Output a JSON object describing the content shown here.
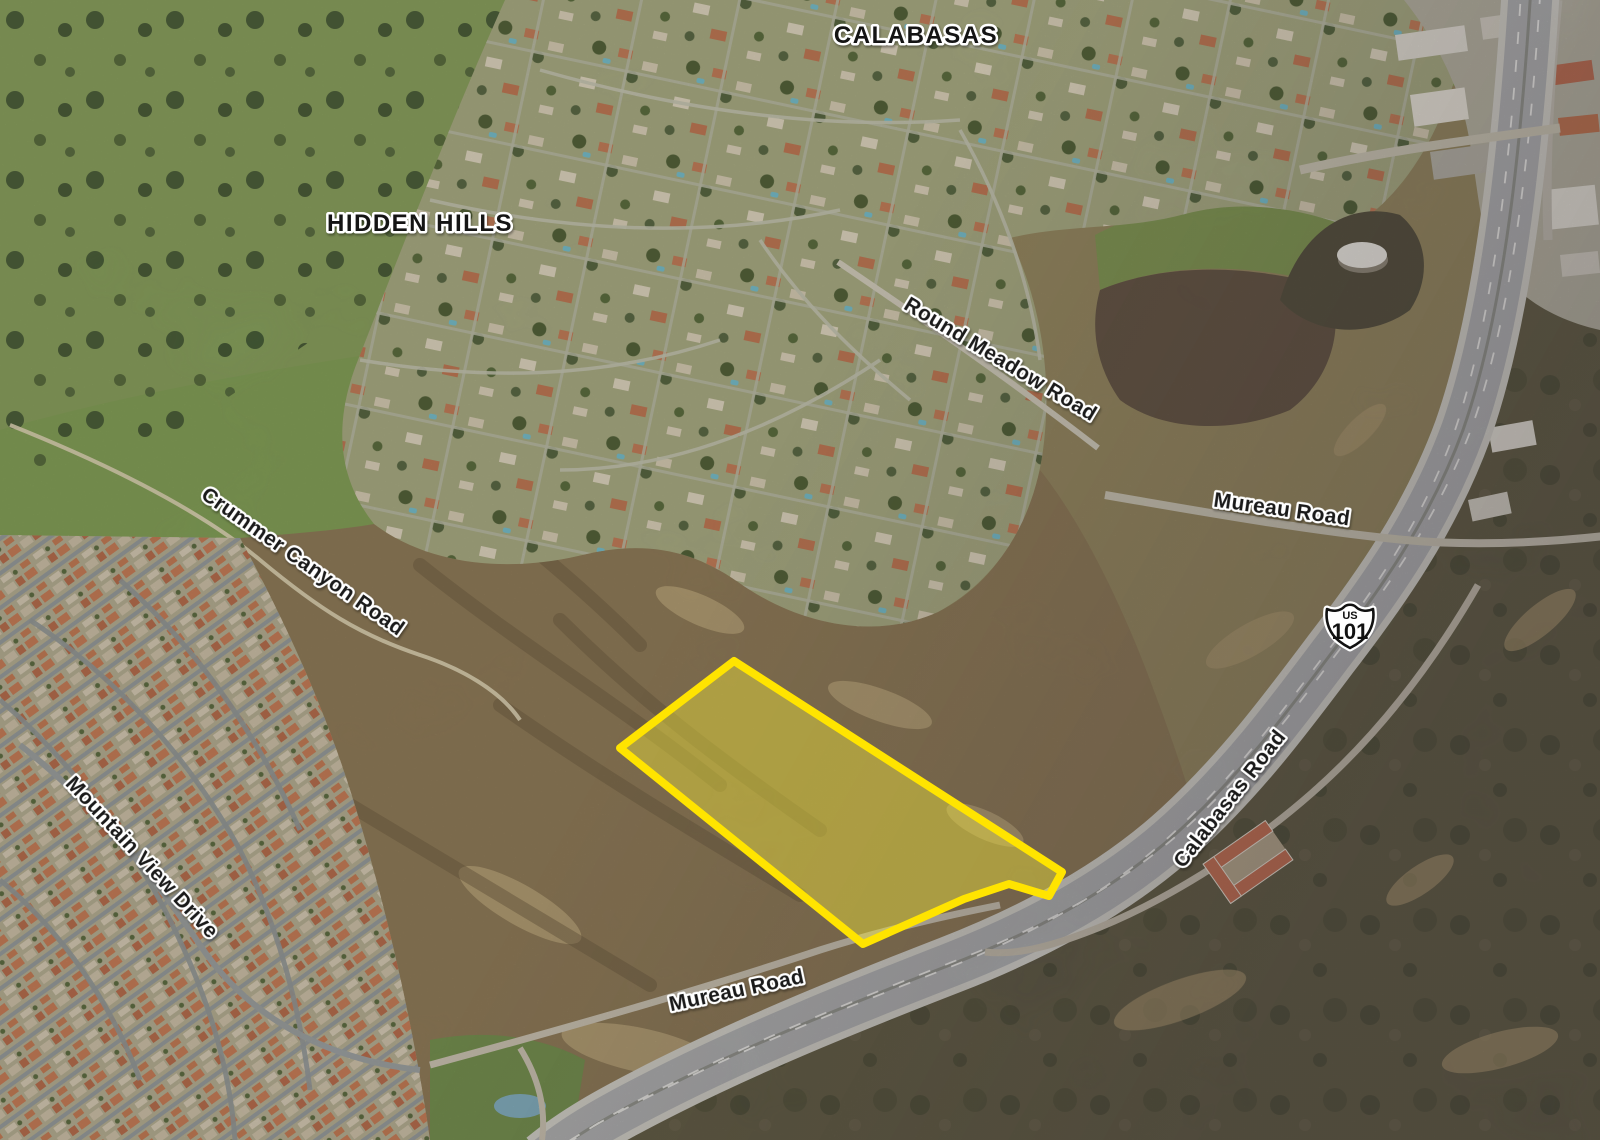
{
  "map": {
    "place_labels": {
      "calabasas": "CALABASAS",
      "hidden_hills": "HIDDEN HILLS"
    },
    "road_labels": {
      "round_meadow": "Round Meadow Road",
      "mureau_upper": "Mureau Road",
      "calabasas_road": "Calabasas Road",
      "crummer_canyon": "Crummer Canyon Road",
      "mountain_view": "Mountain View Drive",
      "mureau_lower": "Mureau Road"
    },
    "highway_shield": {
      "prefix": "US",
      "number": "101"
    },
    "parcel": {
      "outline_color": "#FFE400",
      "fill_color": "#F5EA3A"
    }
  }
}
